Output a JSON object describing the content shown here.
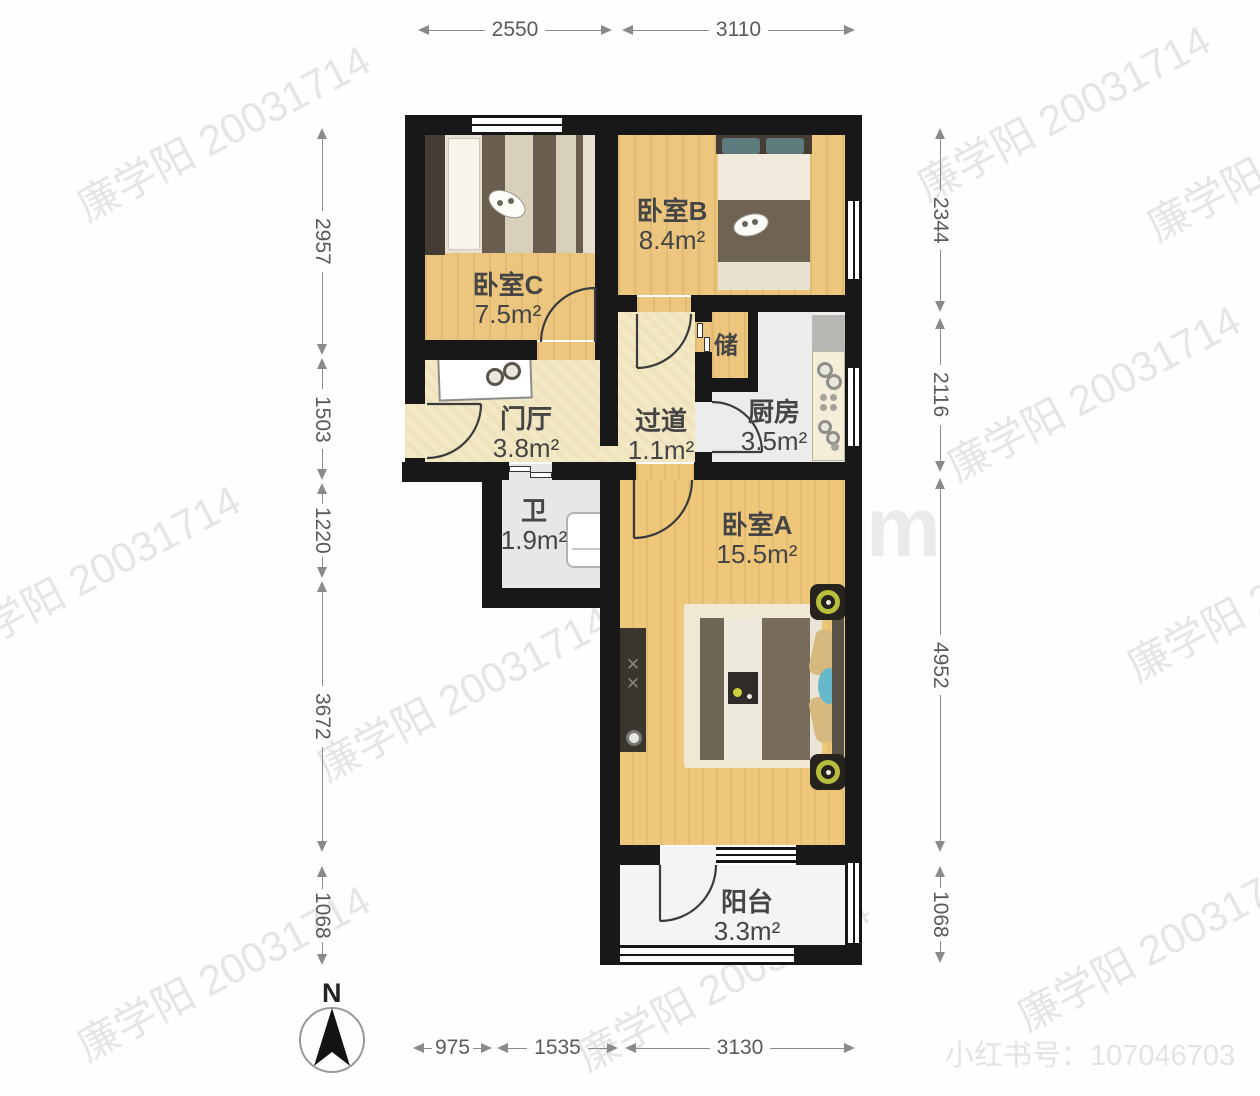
{
  "plan": {
    "rooms": {
      "bedroomC": {
        "name": "卧室C",
        "area": "7.5m²"
      },
      "bedroomB": {
        "name": "卧室B",
        "area": "8.4m²"
      },
      "bedroomA": {
        "name": "卧室A",
        "area": "15.5m²"
      },
      "storage": {
        "name": "储"
      },
      "kitchen": {
        "name": "厨房",
        "area": "3.5m²"
      },
      "hall": {
        "name": "门厅",
        "area": "3.8m²"
      },
      "corridor": {
        "name": "过道",
        "area": "1.1m²"
      },
      "bath": {
        "name": "卫",
        "area": "1.9m²"
      },
      "balcony": {
        "name": "阳台",
        "area": "3.3m²"
      }
    },
    "dimensions": {
      "top": [
        "2550",
        "3110"
      ],
      "bottom": [
        "975",
        "1535",
        "3130"
      ],
      "left": [
        "2957",
        "1503",
        "1220",
        "3672",
        "1068"
      ],
      "right": [
        "2344",
        "2116",
        "4952",
        "1068"
      ]
    },
    "compass": {
      "label": "N"
    },
    "watermarks": {
      "owner": "廉学阳 20031714",
      "brand": "JIC家om",
      "social": "小红书号：107046703"
    },
    "colors": {
      "wall": "#181818",
      "bedroom_floor": "#ecc67e",
      "hall_floor": "#f3e8c4",
      "kitchen_floor": "#ececea",
      "lamp_ring": "#b9be3c",
      "pillow_teal": "#5d7a7c"
    }
  }
}
